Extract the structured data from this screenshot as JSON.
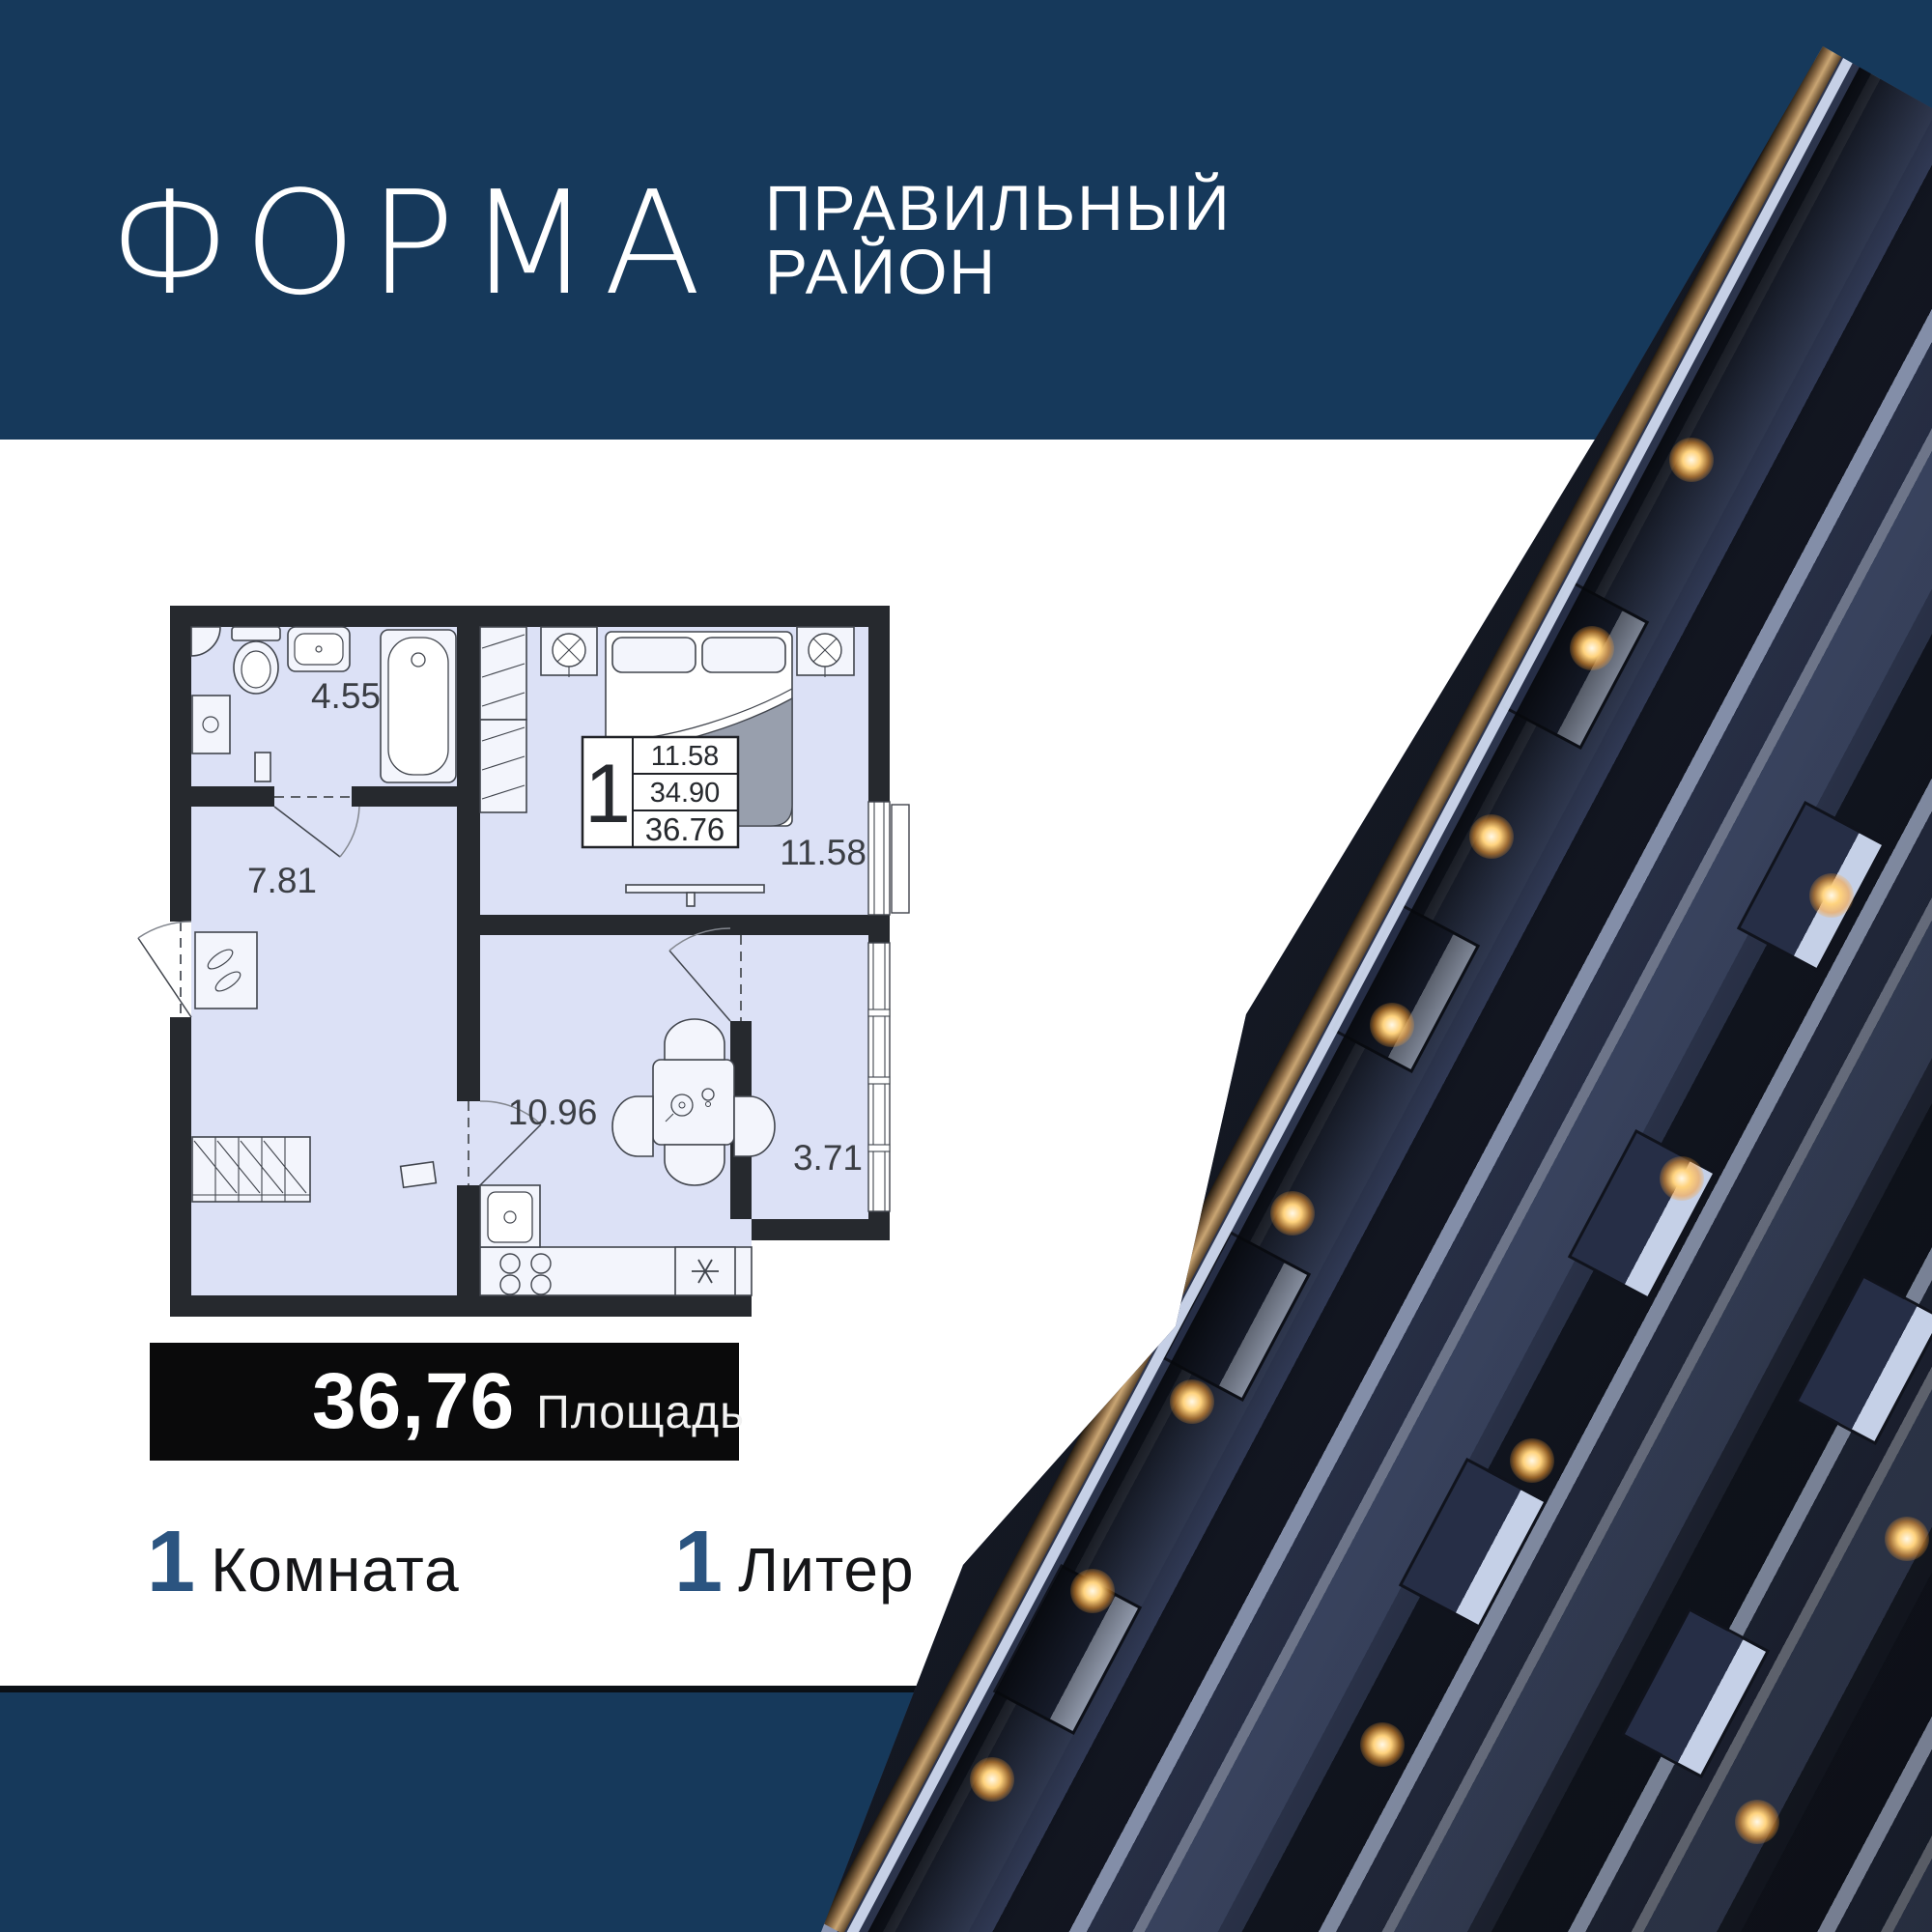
{
  "brand": {
    "logo": "ФОРМА",
    "tagline_line1": "ПРАВИЛЬНЫЙ",
    "tagline_line2": "РАЙОН"
  },
  "plan": {
    "legend": {
      "rooms_count": "1",
      "row1": "11.58",
      "row2": "34.90",
      "row3": "36.76"
    },
    "labels": {
      "bathroom": "4.55",
      "hallway": "7.81",
      "kitchen": "10.96",
      "bedroom": "11.58",
      "balcony": "3.71"
    }
  },
  "summary": {
    "area_value": "36,76",
    "area_label": "Площадь",
    "rooms_value": "1",
    "rooms_label": "Комната",
    "liter_value": "1",
    "liter_label": "Литер"
  },
  "colors": {
    "navy_band": "#16395B",
    "footer_line": "#0B1016",
    "plan_wall": "#26292E",
    "plan_fill": "#DCE1F6",
    "summary_bg": "#0A0A0B",
    "stat_number": "#2B5480",
    "light_warm": "#FFC26B",
    "facade_blue": "#8593B6",
    "soffit_bronze": "#C9A573"
  }
}
